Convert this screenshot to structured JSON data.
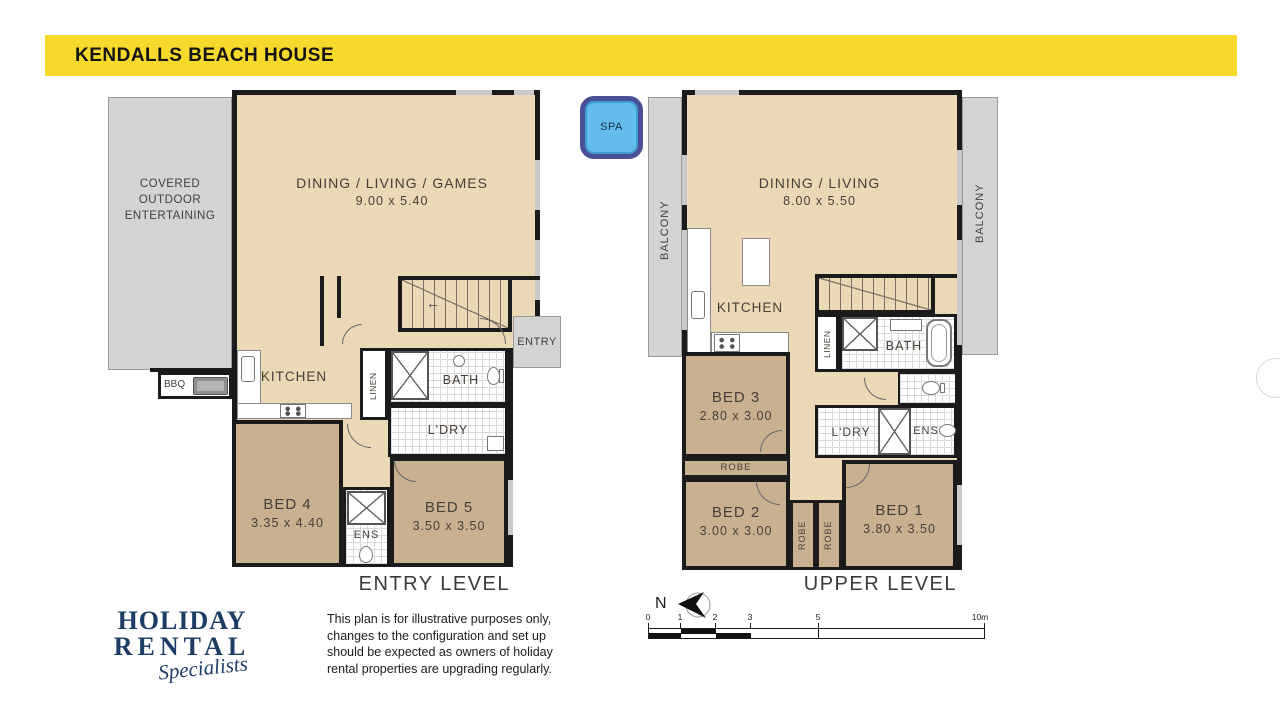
{
  "colors": {
    "header_yellow": "#F6D92B",
    "room_beige": "#EAD9B4",
    "bedroom_tan": "#C9B190",
    "outdoor_gray": "#D4D4D3",
    "wall_black": "#1B1B1B",
    "spa_blue": "#64BCEC",
    "spa_border": "#4A5096",
    "logo_navy": "#1D3C66"
  },
  "header": {
    "title": "KENDALLS BEACH HOUSE"
  },
  "entry_level": {
    "outdoor_label": "COVERED\nOUTDOOR\nENTERTAINING",
    "bbq_label": "BBQ",
    "dining_name": "DINING / LIVING / GAMES",
    "dining_dims": "9.00 x 5.40",
    "kitchen_label": "KITCHEN",
    "linen_label": "LINEN",
    "bath_label": "BATH",
    "ldry_label": "L'DRY",
    "entry_label": "ENTRY",
    "bed4_name": "BED 4",
    "bed4_dims": "3.35 x 4.40",
    "ens_label": "ENS",
    "bed5_name": "BED 5",
    "bed5_dims": "3.50 x 3.50",
    "caption": "ENTRY LEVEL"
  },
  "upper_level": {
    "spa_label": "SPA",
    "balcony_left_label": "BALCONY",
    "balcony_right_label": "BALCONY",
    "dining_name": "DINING / LIVING",
    "dining_dims": "8.00 x 5.50",
    "kitchen_label": "KITCHEN",
    "linen_label": "LINEN",
    "bath_label": "BATH",
    "bed3_name": "BED 3",
    "bed3_dims": "2.80 x 3.00",
    "robe_label": "ROBE",
    "ldry_label": "L'DRY",
    "ens_label": "ENS",
    "bed2_name": "BED 2",
    "bed2_dims": "3.00 x 3.00",
    "robe_v1_label": "ROBE",
    "robe_v2_label": "ROBE",
    "bed1_name": "BED 1",
    "bed1_dims": "3.80 x 3.50",
    "caption": "UPPER LEVEL"
  },
  "footer": {
    "logo_line1": "HOLIDAY",
    "logo_line2": "RENTAL",
    "logo_line3": "Specialists",
    "disclaimer": "This plan is for illustrative purposes only,\nchanges to the configuration and set up\nshould be expected as owners of holiday\nrental properties are upgrading regularly.",
    "north_label": "N",
    "scale_labels": [
      "0",
      "1",
      "2",
      "3",
      "5",
      "10m"
    ]
  }
}
